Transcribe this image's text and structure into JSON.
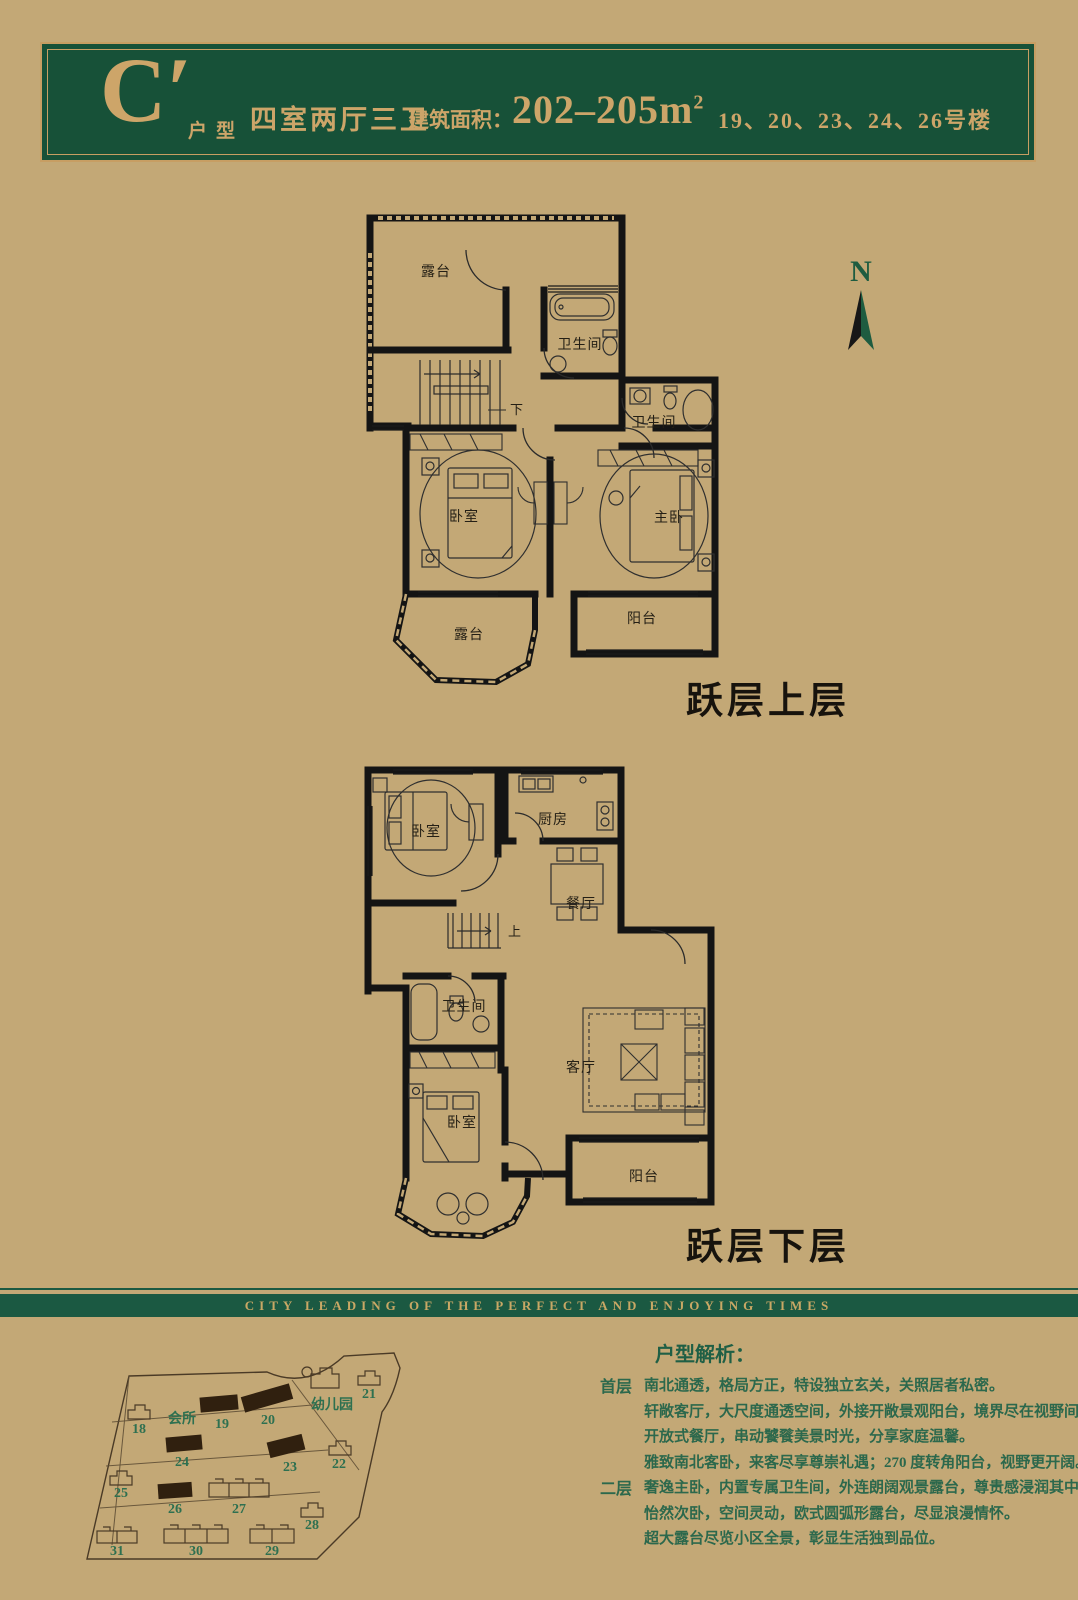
{
  "colors": {
    "background": "#c3a876",
    "brand_green": "#175138",
    "band_green": "#1b5942",
    "gold": "#cda569",
    "text_green": "#2c684c",
    "plan_ink": "#141414"
  },
  "header": {
    "type_letter": "C′",
    "type_label": "户型",
    "layout_text": "四室两厅三卫",
    "area_label": "建筑面积：",
    "area_value": "202–205",
    "area_unit": "m",
    "area_sup": "2",
    "buildings_text": "19、20、23、24、26号楼"
  },
  "compass": {
    "label": "N"
  },
  "upper_plan": {
    "caption": "跃层上层",
    "rooms": {
      "terrace_top": "露台",
      "bath1": "卫生间",
      "bath2": "卫生间",
      "bedroom": "卧室",
      "master": "主卧",
      "terrace_bottom": "露台",
      "balcony": "阳台",
      "stairs_dir": "下"
    }
  },
  "lower_plan": {
    "caption": "跃层下层",
    "rooms": {
      "bedroom_top": "卧室",
      "kitchen": "厨房",
      "dining": "餐厅",
      "bath": "卫生间",
      "living": "客厅",
      "bedroom_bottom": "卧室",
      "balcony": "阳台",
      "stairs_dir": "上"
    }
  },
  "divider": {
    "slogan": "CITY LEADING OF THE PERFECT AND ENJOYING TIMES"
  },
  "site_map": {
    "clubhouse": "会所",
    "kindergarten": "幼儿园",
    "highlighted_buildings": [
      "19",
      "20",
      "23",
      "24",
      "26"
    ],
    "numbers": {
      "18": "18",
      "19": "19",
      "20": "20",
      "21": "21",
      "22": "22",
      "23": "23",
      "24": "24",
      "25": "25",
      "26": "26",
      "27": "27",
      "28": "28",
      "29": "29",
      "30": "30",
      "31": "31"
    }
  },
  "analysis": {
    "title": "户型解析：",
    "sections": [
      {
        "label": "首层",
        "lines": [
          "南北通透，格局方正，特设独立玄关，关照居者私密。",
          "轩敞客厅，大尺度通透空间，外接开敞景观阳台，境界尽在视野间。",
          "开放式餐厅，串动饕餮美景时光，分享家庭温馨。",
          "雅致南北客卧，来客尽享尊崇礼遇；270 度转角阳台，视野更开阔。"
        ]
      },
      {
        "label": "二层",
        "lines": [
          "奢逸主卧，内置专属卫生间，外连朗阔观景露台，尊贵感浸润其中。",
          "怡然次卧，空间灵动，欧式圆弧形露台，尽显浪漫情怀。",
          "超大露台尽览小区全景，彰显生活独到品位。"
        ]
      }
    ]
  }
}
